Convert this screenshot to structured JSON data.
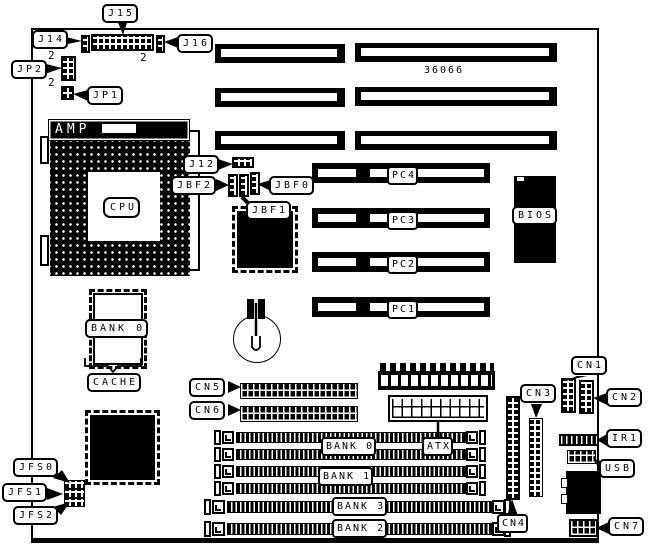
{
  "diagram": {
    "part_number": "36066",
    "pin2_marker": "2",
    "labels": {
      "j15": "J15",
      "j14": "J14",
      "j16": "J16",
      "jp2": "JP2",
      "jp1": "JP1",
      "amp": "AMP",
      "cpu": "CPU",
      "j12": "J12",
      "jbf2": "JBF2",
      "jbf0": "JBF0",
      "jbf1": "JBF1",
      "pc4": "PC4",
      "pc3": "PC3",
      "pc2": "PC2",
      "pc1": "PC1",
      "bios": "BIOS",
      "cache_bank0": "BANK 0",
      "cache": "CACHE",
      "cn5": "CN5",
      "cn6": "CN6",
      "cn1": "CN1",
      "cn2": "CN2",
      "cn3": "CN3",
      "cn4": "CN4",
      "cn7": "CN7",
      "ir1": "IR1",
      "usb": "USB",
      "atx": "ATX",
      "bank0": "BANK 0",
      "bank1": "BANK 1",
      "bank2": "BANK 2",
      "bank3": "BANK 3",
      "jfs0": "JFS0",
      "jfs1": "JFS1",
      "jfs2": "JFS2"
    }
  }
}
